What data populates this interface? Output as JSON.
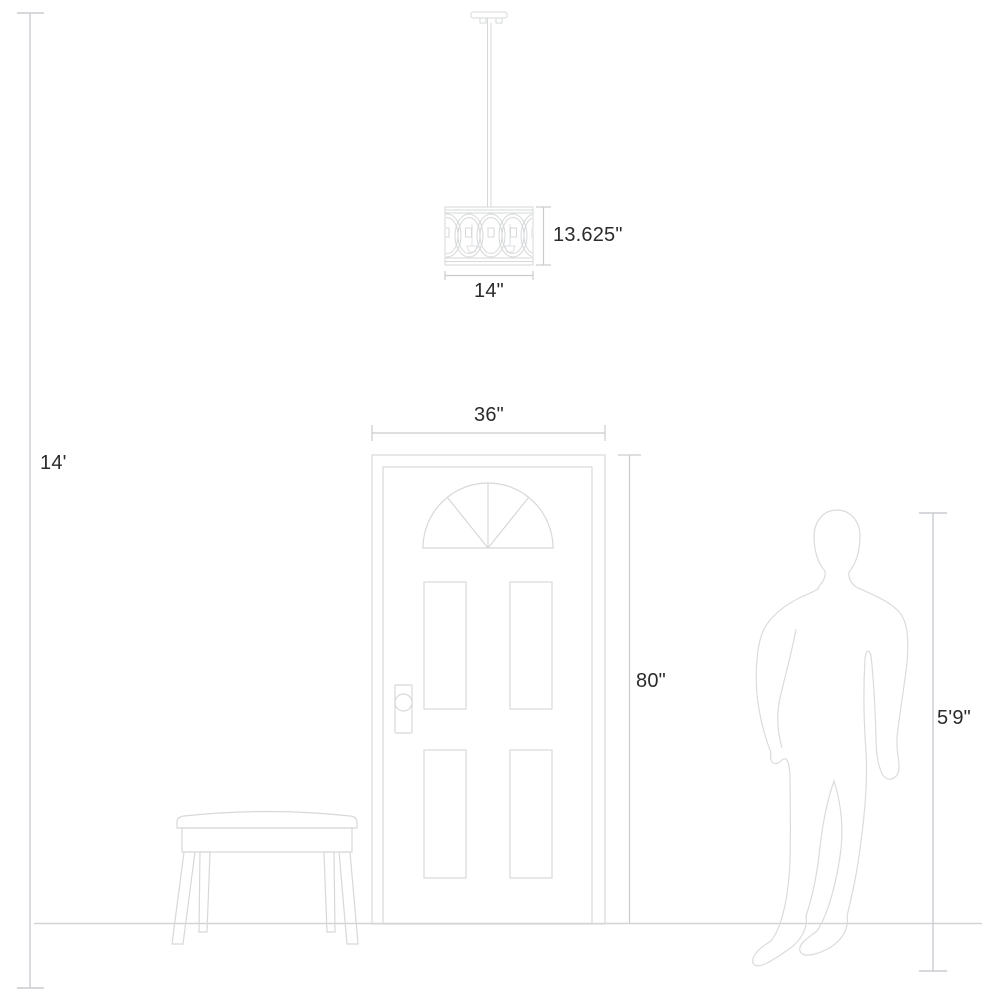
{
  "diagram": {
    "type": "product-scale-diagram",
    "background_color": "#ffffff",
    "artwork_line_color": "#d6d8da",
    "dimension_line_color": "#c9cccf",
    "label_text_color": "#2b2b2b",
    "labels": {
      "ceiling_height": "14'",
      "fixture_height": "13.625\"",
      "fixture_width": "14\"",
      "door_width": "36\"",
      "door_height": "80\"",
      "person_height": "5'9\""
    }
  }
}
